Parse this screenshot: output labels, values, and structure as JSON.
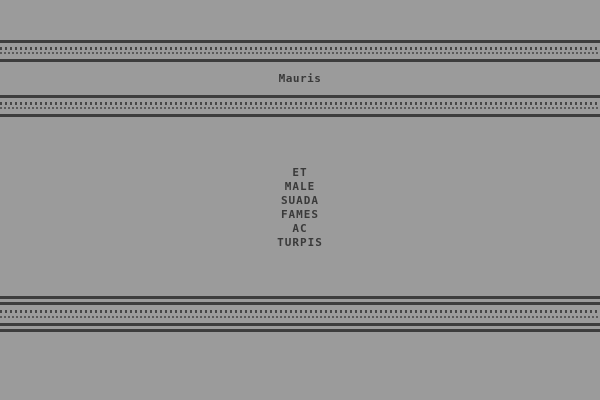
{
  "theme": {
    "background": "#9b9b9b",
    "rule": "#3d3d3d",
    "dot1": "#464646",
    "dot2": "#5a5a5a",
    "text": "#3a3a3a"
  },
  "header": {
    "title": "Mauris"
  },
  "body": {
    "words": [
      "ET",
      "MALE",
      "SUADA",
      "FAMES",
      "AC",
      "TURPIS"
    ]
  }
}
